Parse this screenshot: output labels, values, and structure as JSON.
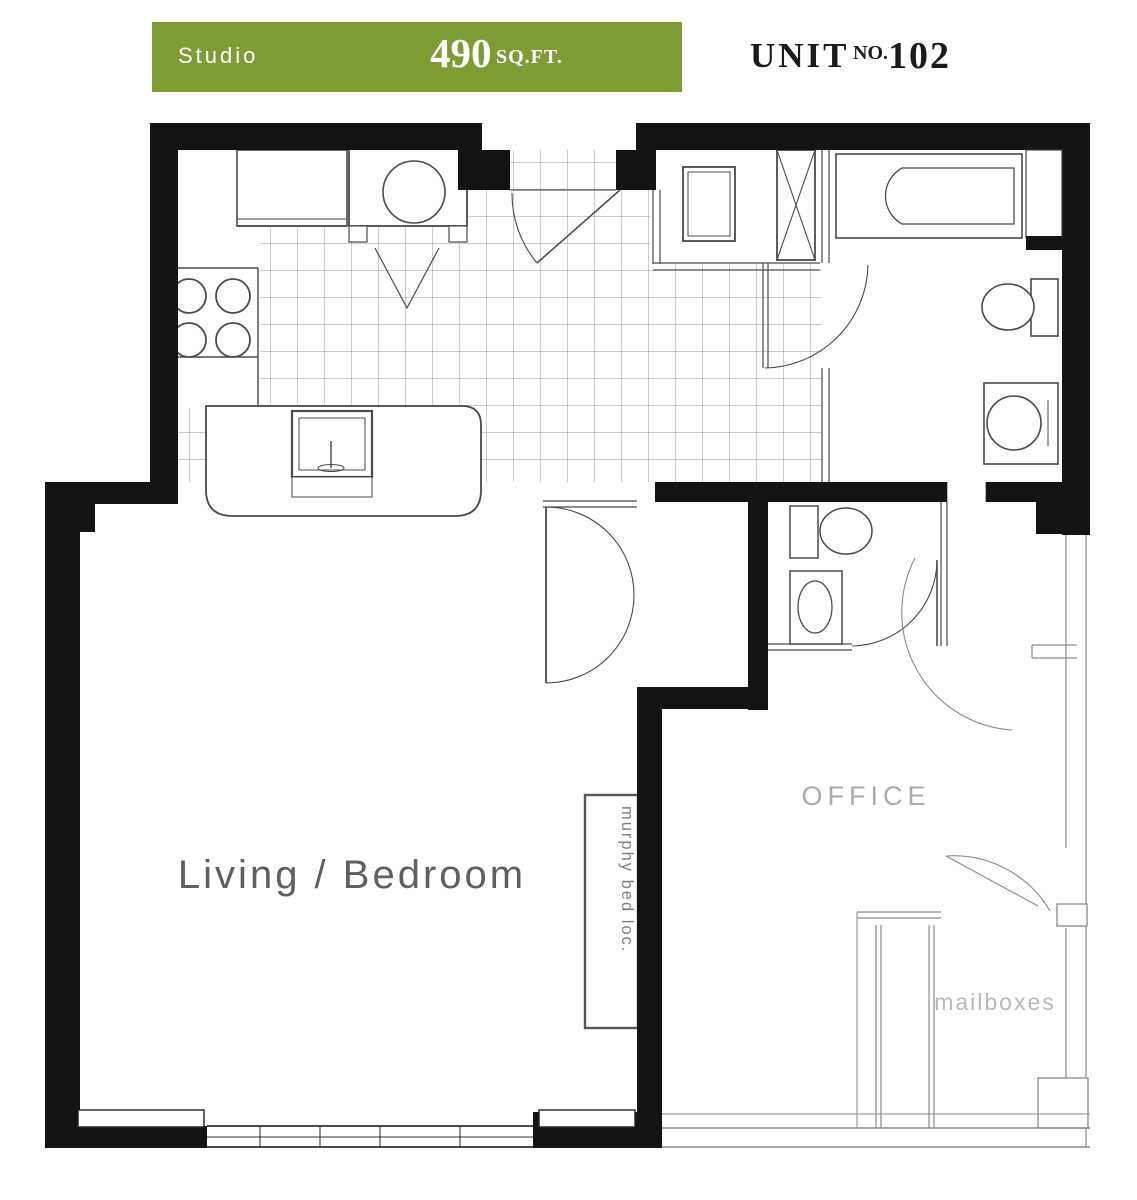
{
  "header": {
    "type_label": "Studio",
    "area_value": "490",
    "area_unit": "SQ.FT.",
    "unit_word": "UNIT",
    "unit_no_label": "NO.",
    "unit_number": "102",
    "bar_color": "#7d9c34",
    "text_color": "#1b1b1b"
  },
  "floorplan": {
    "labels": {
      "living": "Living / Bedroom",
      "office": "OFFICE",
      "mailboxes": "mailboxes",
      "murphy_bed": "murphy bed loc."
    },
    "colors": {
      "wall": "#141414",
      "line": "#4a4a4a",
      "light_line": "#8a8a8a",
      "tile": "#9a9a9a",
      "label_dark": "#5f5f5f",
      "label_mid": "#808080",
      "label_light": "#ababab",
      "label_faint": "#b8b8b8"
    }
  }
}
